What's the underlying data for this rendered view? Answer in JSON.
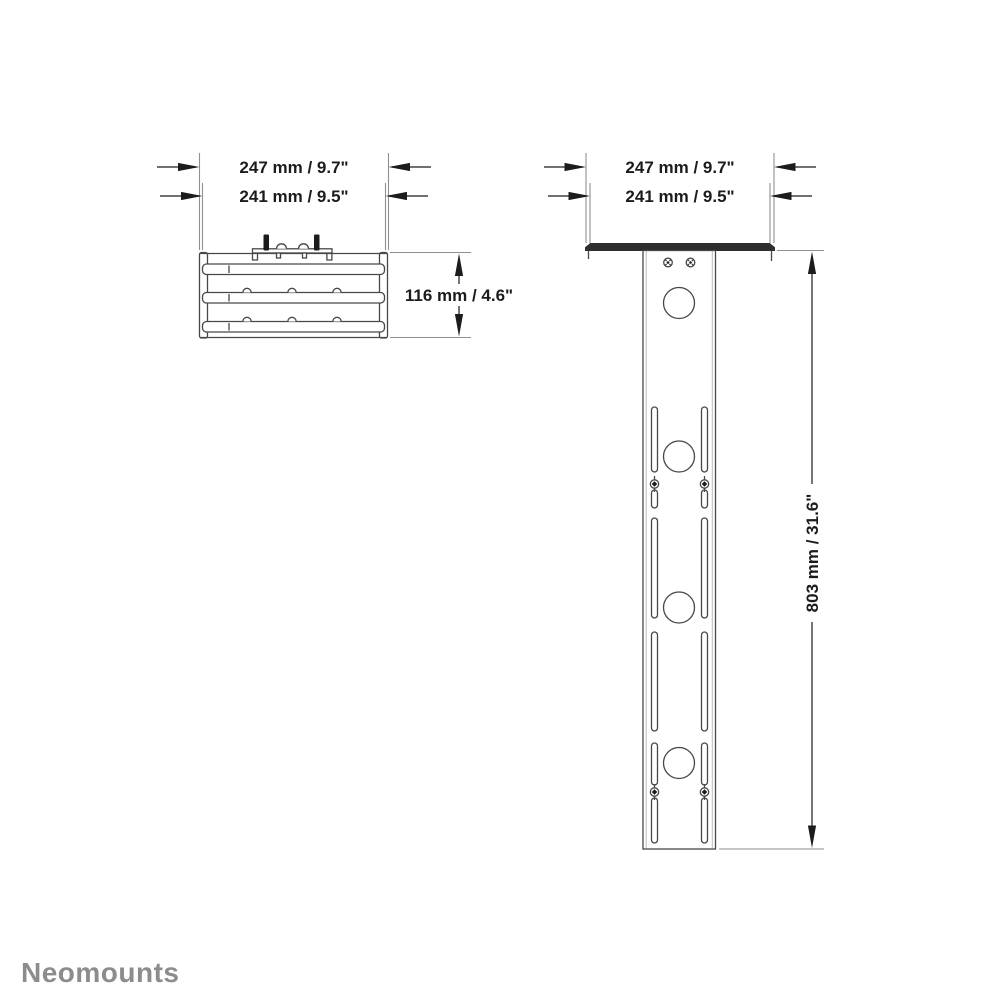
{
  "brand": {
    "logo_text": "Neomounts",
    "color": "#8c8c8c"
  },
  "views": {
    "front": {
      "title": "shelf-front-view",
      "dims": {
        "width_outer": "247 mm / 9.7\"",
        "width_inner": "241 mm / 9.5\"",
        "height": "116 mm / 4.6\""
      }
    },
    "side": {
      "title": "column-side-view",
      "dims": {
        "width_outer": "247 mm / 9.7\"",
        "width_inner": "241 mm / 9.5\"",
        "height": "803 mm / 31.6\""
      }
    }
  },
  "colors": {
    "background": "#ffffff",
    "part_line": "#474747",
    "part_line_light": "#b9b9b9",
    "dimension": "#1c1c1c",
    "extension_line": "#8f8f8f",
    "plate_fill": "#2e2e2e",
    "bolt_fill": "#1c1c1c",
    "brand": "#8c8c8c"
  }
}
